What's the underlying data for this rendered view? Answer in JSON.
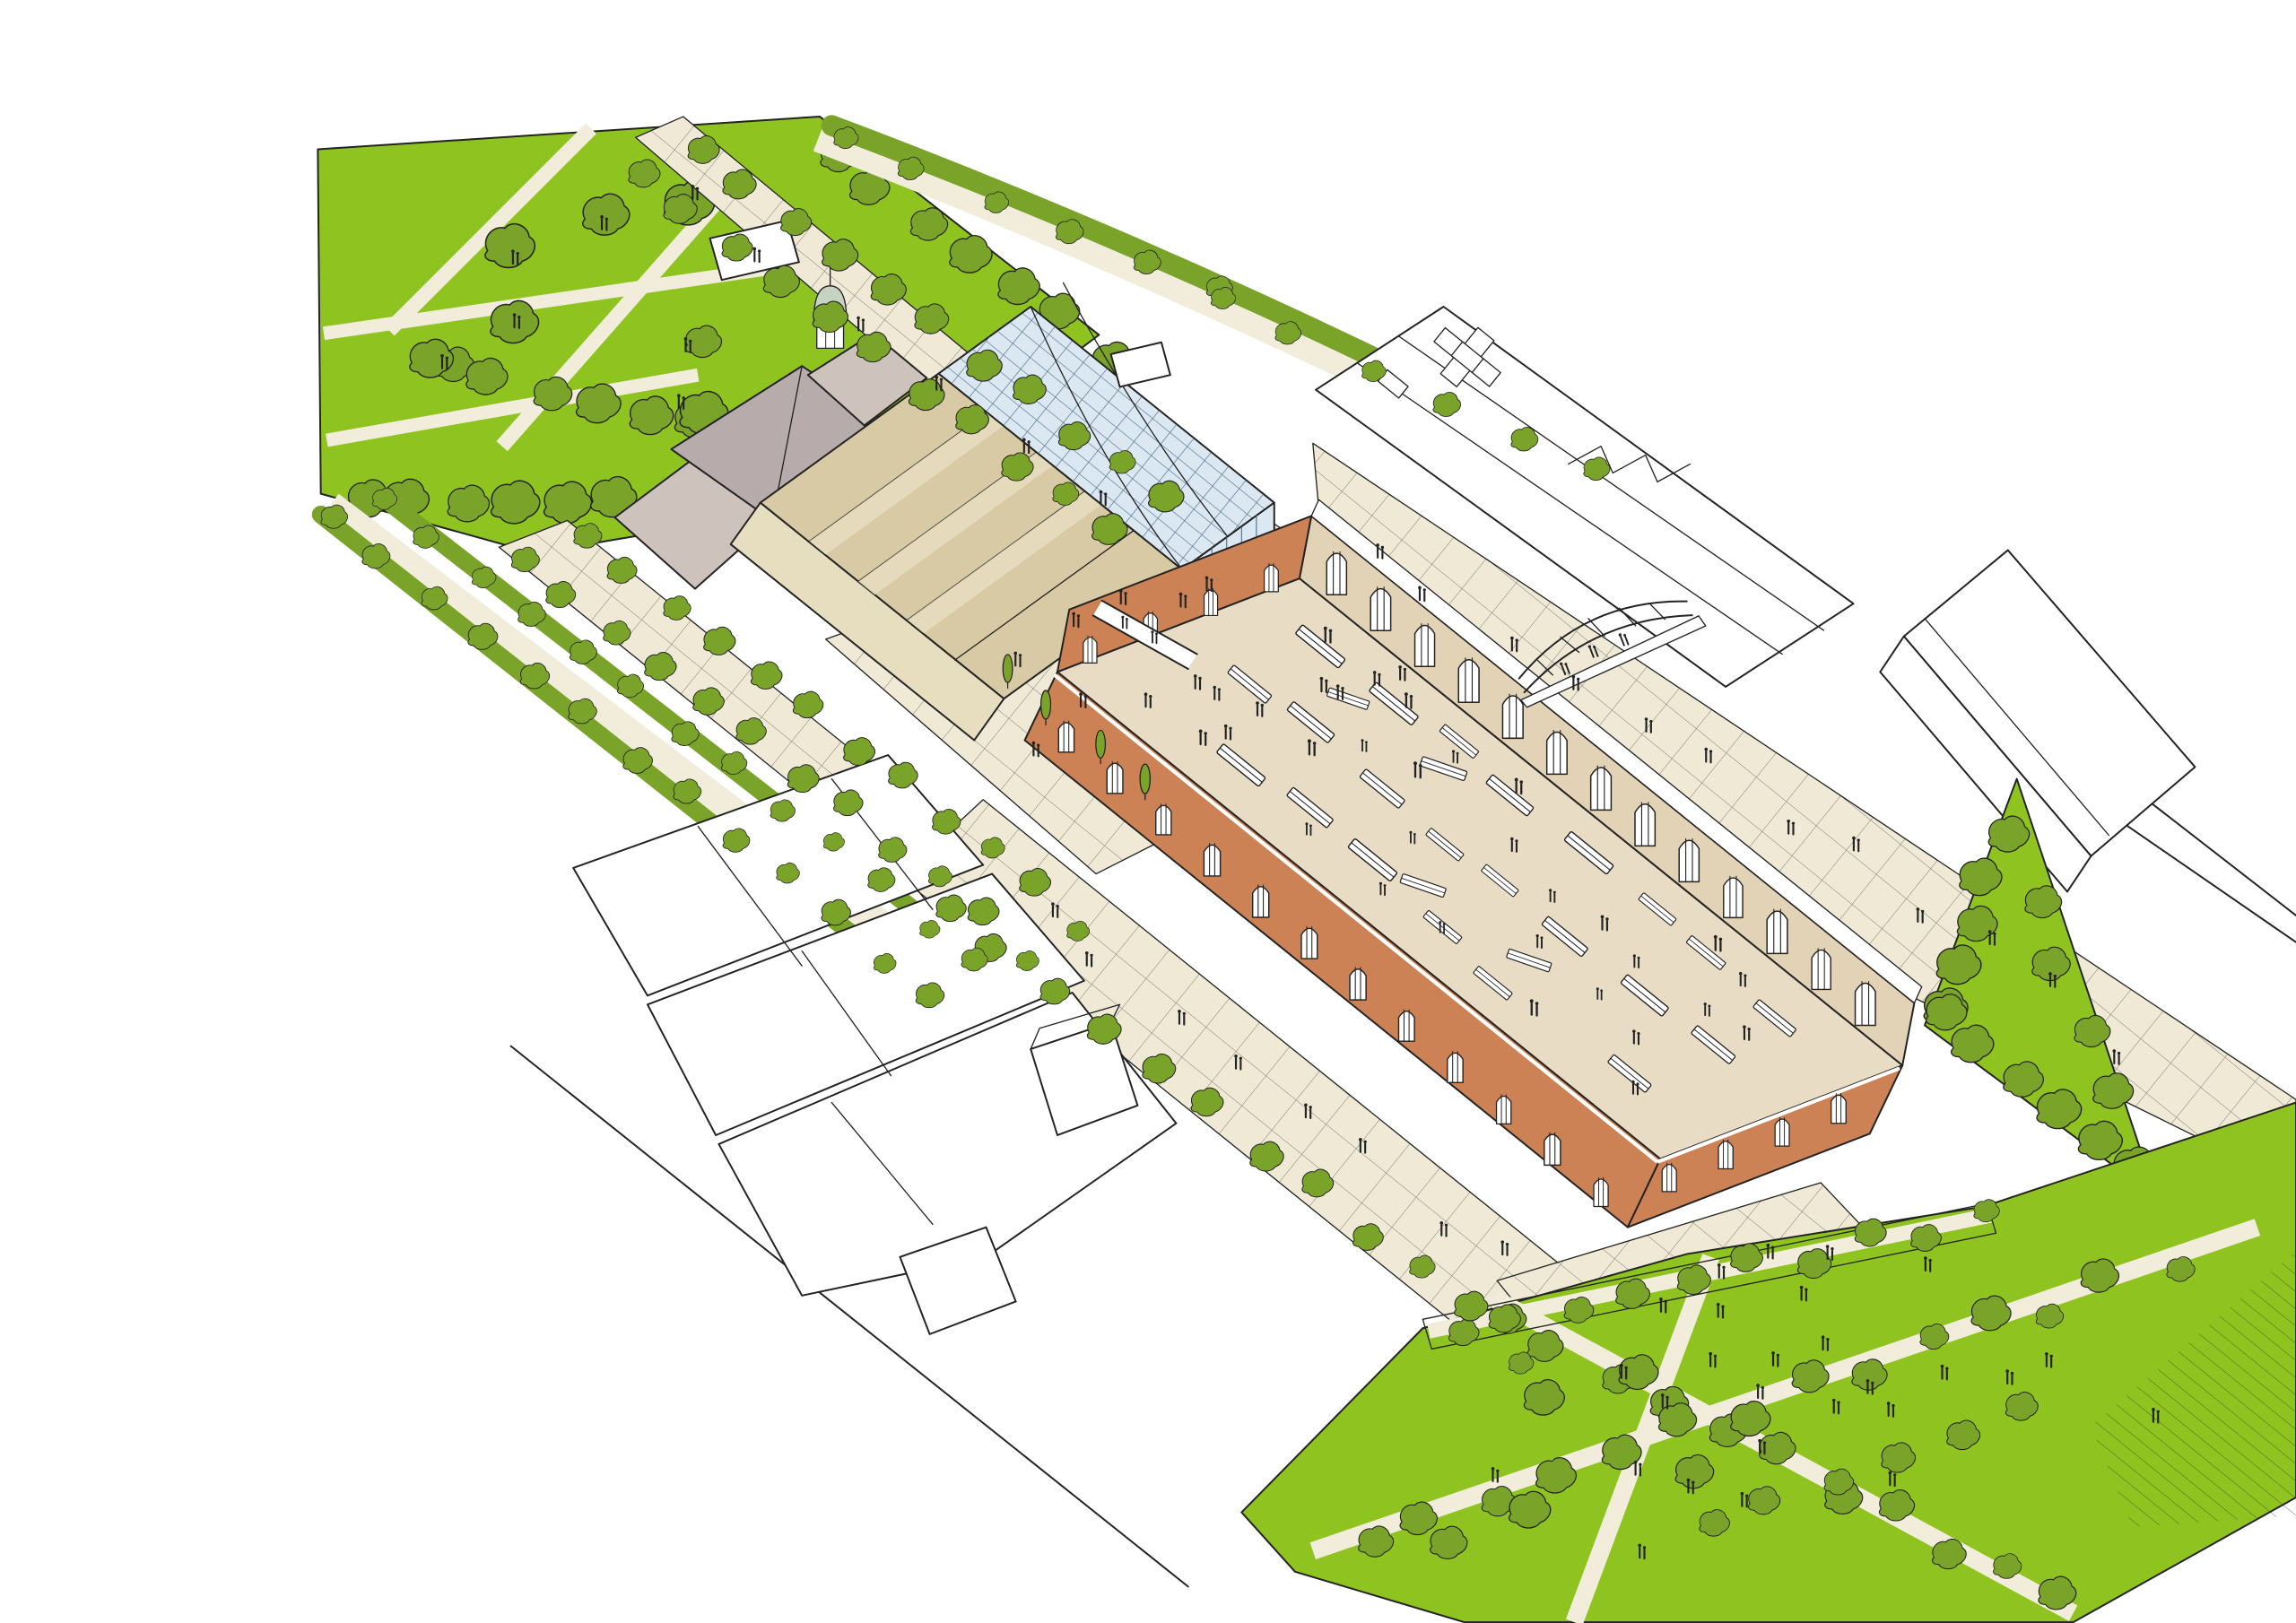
{
  "scene": {
    "kind": "hand-drawn aerial axonometric masterplan sketch",
    "elements": [
      "park-northwest",
      "tree-lined-boulevard",
      "left-street-hedges",
      "glass-roofed-building",
      "stepped-terrace-building",
      "cupola-dome",
      "grey-roof-block",
      "west-plaza",
      "market-hall",
      "market-stalls",
      "brick-arcade-wall",
      "clerestory-arch-wall",
      "truss-footbridge",
      "west-footbridge",
      "white-outline-buildings-northeast",
      "white-outline-buildings-southwest",
      "triangle-park-east",
      "park-southeast",
      "crosshatched-plazas",
      "pedestrians",
      "street-trees"
    ]
  },
  "colors": {
    "ink": "#232323",
    "lawn": "#8fc31f",
    "tree": "#7aa32a",
    "path": "#f1edda",
    "pave": "#efe9d6",
    "glass": "#dbe8f2",
    "glassline": "#41607a",
    "terrace": "#d8caa4",
    "terracelight": "#e7ddbf",
    "roofgrey": "#b7abab",
    "roofgreylight": "#cdc3bc",
    "dome": "#c6d3c3",
    "floor": "#e9dcc5",
    "wallbeige": "#e3d3b6",
    "brick": "#cc8254",
    "white": "#ffffff"
  }
}
